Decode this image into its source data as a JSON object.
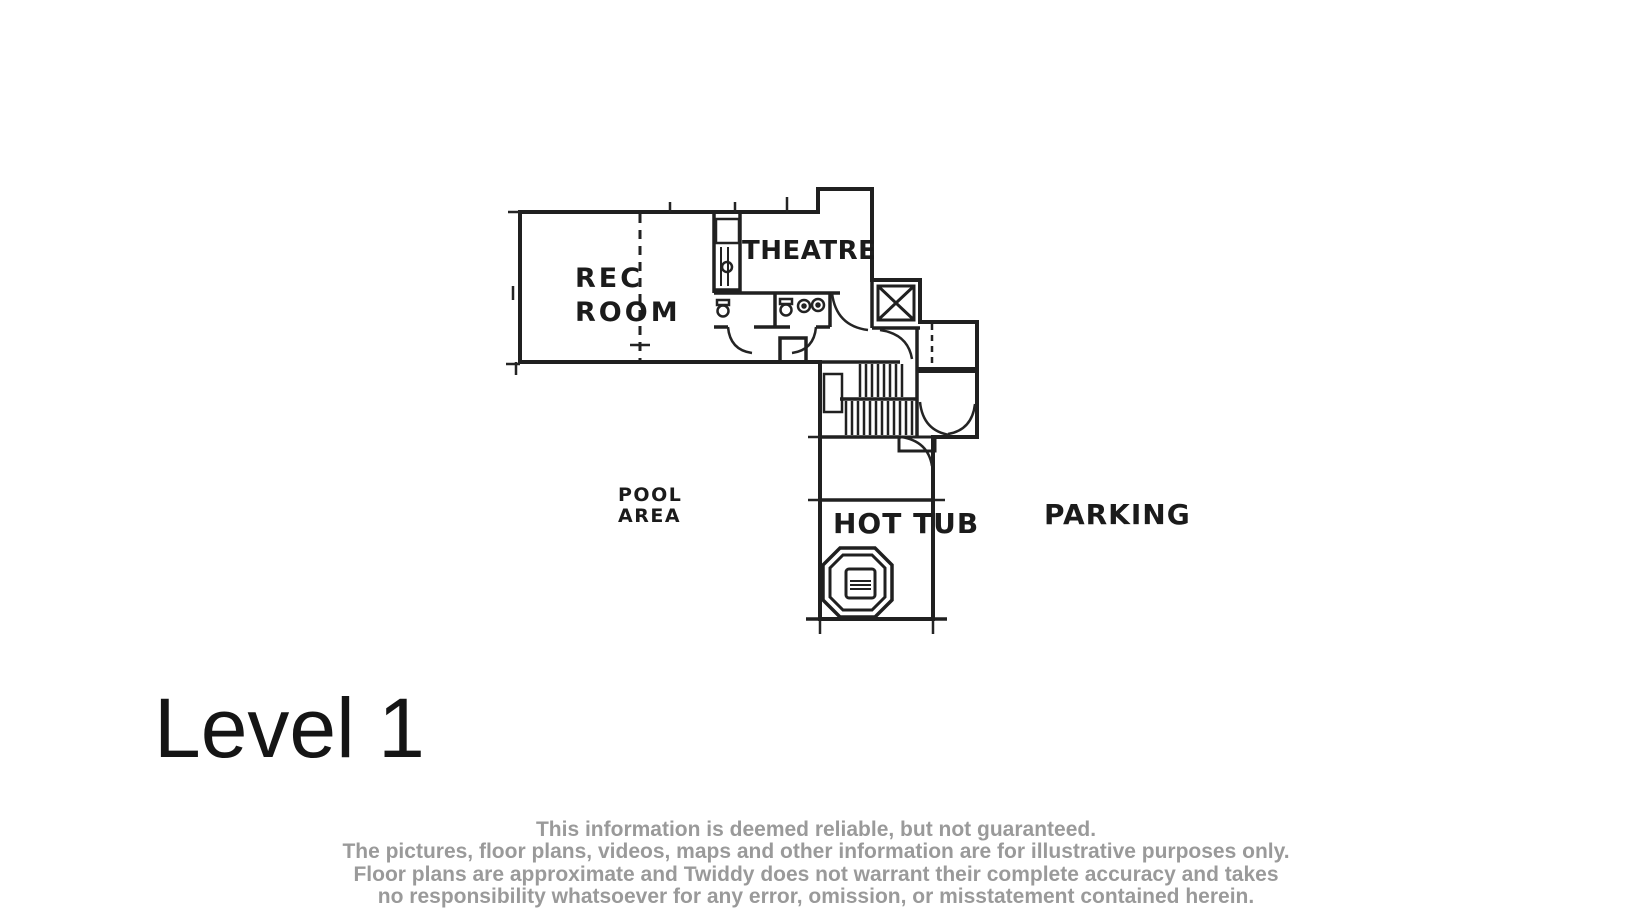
{
  "plan": {
    "labels": {
      "rec_room_line1": "REC",
      "rec_room_line2": "ROOM",
      "theatre": "THEATRE",
      "pool_area_line1": "POOL",
      "pool_area_line2": "AREA",
      "hot_tub": "HOT TUB",
      "parking": "PARKING"
    },
    "features": [
      "elevator",
      "stairs",
      "bathrooms",
      "shower-closet",
      "hot-tub",
      "entry-porch",
      "chimney"
    ]
  },
  "level": {
    "title": "Level 1"
  },
  "disclaimer": {
    "line1": "This information is deemed reliable, but not guaranteed.",
    "line2": "The pictures, floor plans, videos, maps and other information are for illustrative purposes only.",
    "line3": "Floor plans are approximate and Twiddy does not warrant their complete accuracy and takes",
    "line4": "no responsibility whatsoever for any error, omission, or misstatement contained herein."
  },
  "colors": {
    "background": "#ffffff",
    "wall": "#202020",
    "label": "#1b1b1b",
    "title": "#151515",
    "disclaimer_text": "#9a9a9a"
  }
}
